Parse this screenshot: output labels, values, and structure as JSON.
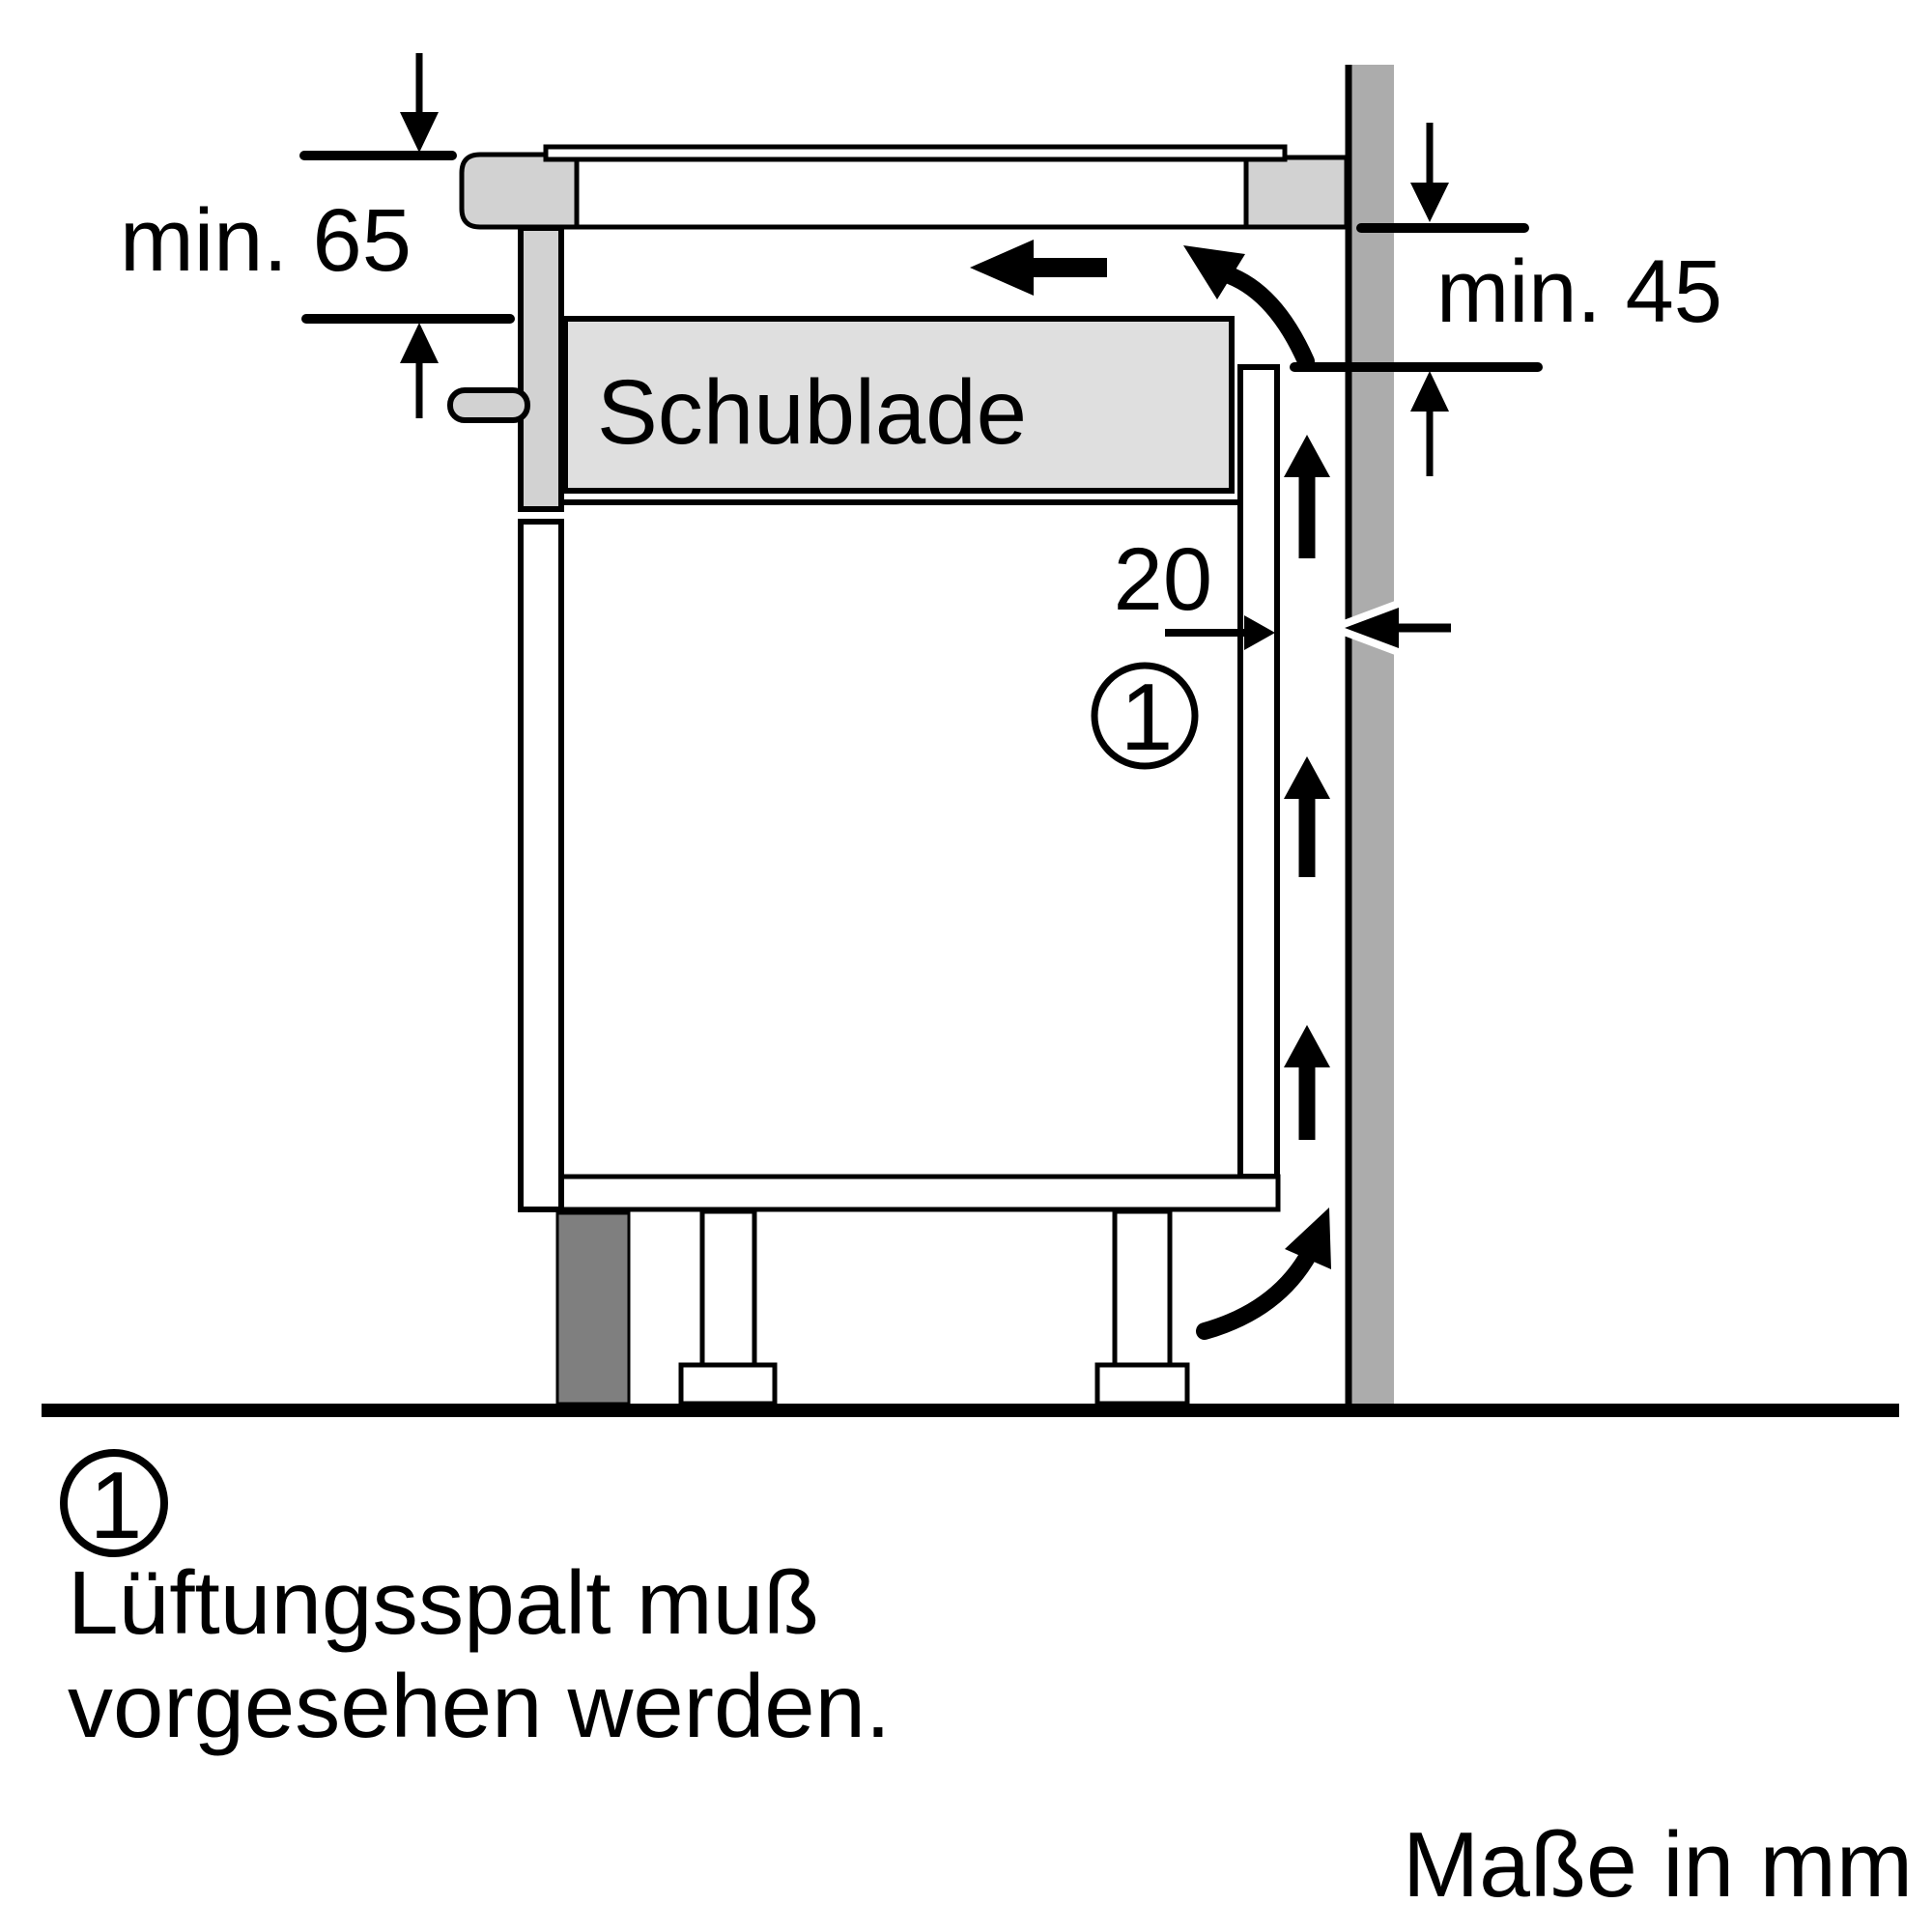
{
  "diagram": {
    "type": "appliance-installation-side-view",
    "labels": {
      "clearance_below_hob": "min. 65",
      "rear_panel_cutout": "min. 45",
      "ventilation_gap_width": "20",
      "drawer": "Schublade",
      "callout_number": "1"
    },
    "footnote": {
      "number": "1",
      "line1": "Lüftungsspalt muß",
      "line2": "vorgesehen werden."
    },
    "units_note": "Maße in mm",
    "arrows": {
      "airflow_up_gap": "three upward arrows in ventilation gap",
      "airflow_in_bottom": "curved arrow entering gap at plinth",
      "airflow_turn_top": "curved arrow turning under worktop",
      "airflow_out_front": "straight arrow exiting to front",
      "dimension_arrows": "arrowheads on min.65 / min.45 / 20 dimensions"
    },
    "colors": {
      "line_black": "#000000",
      "panel_gray": "#d2d2d2",
      "drawer_gray": "#dfdfdf",
      "wall_gray": "#acacac",
      "plinth_gray": "#7f7f7f",
      "background": "#ffffff"
    }
  }
}
